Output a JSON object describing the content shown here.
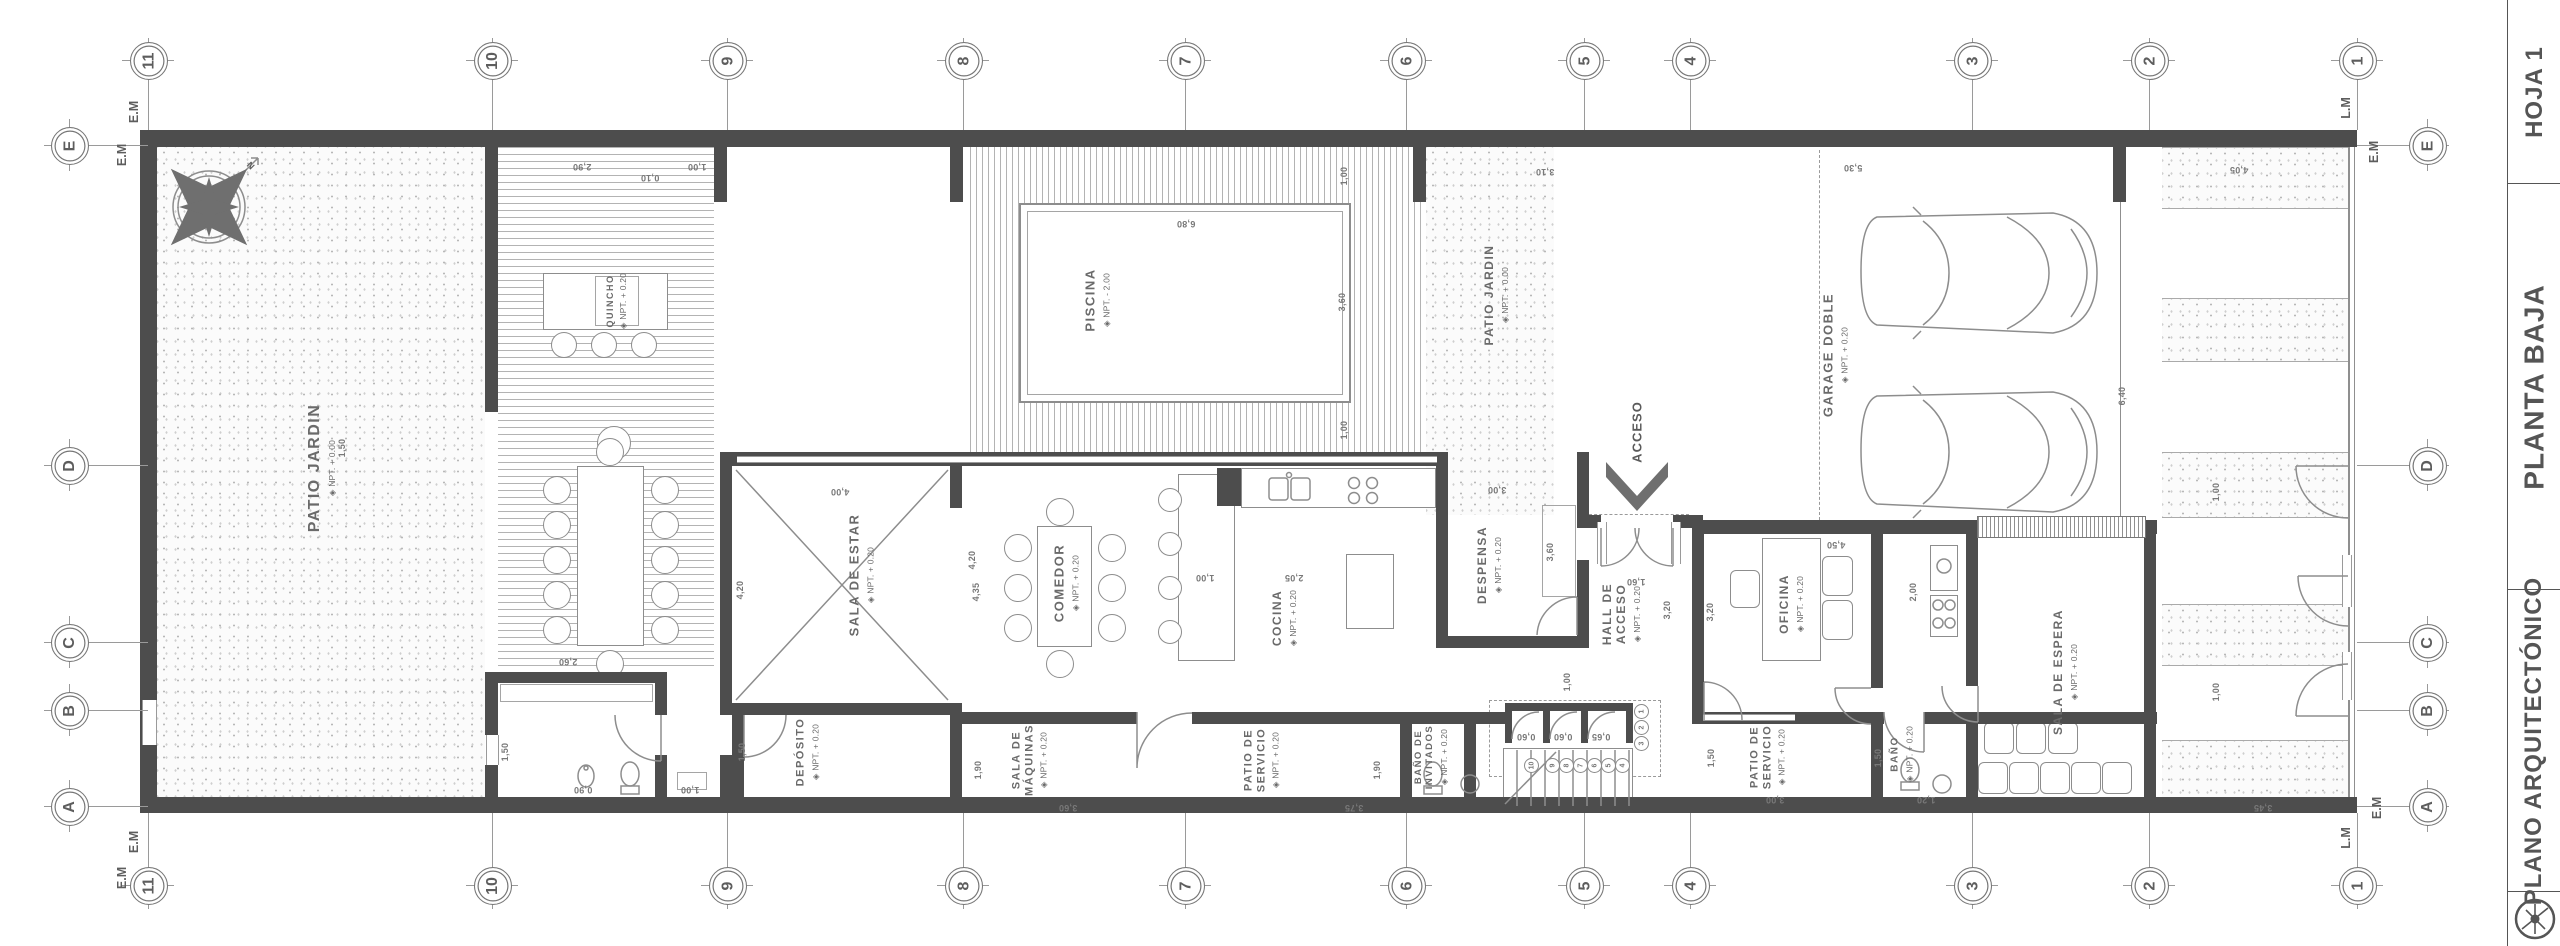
{
  "sheet_type": "architectural floor plan",
  "title_block": {
    "sections": [
      {
        "label": "HOJA 1"
      },
      {
        "label": "PLANTA BAJA"
      },
      {
        "label": "PLANO ARQUITECTÓNICO"
      }
    ]
  },
  "grid": {
    "columns": [
      {
        "label": "11",
        "x": 148
      },
      {
        "label": "10",
        "x": 492
      },
      {
        "label": "9",
        "x": 727
      },
      {
        "label": "8",
        "x": 963
      },
      {
        "label": "7",
        "x": 1185
      },
      {
        "label": "6",
        "x": 1406
      },
      {
        "label": "5",
        "x": 1584
      },
      {
        "label": "4",
        "x": 1690
      },
      {
        "label": "3",
        "x": 1972
      },
      {
        "label": "2",
        "x": 2149
      },
      {
        "label": "1",
        "x": 2357
      }
    ],
    "rows": [
      {
        "label": "E",
        "y": 145
      },
      {
        "label": "D",
        "y": 465
      },
      {
        "label": "C",
        "y": 642
      },
      {
        "label": "B",
        "y": 710
      },
      {
        "label": "A",
        "y": 806
      }
    ],
    "boundary_labels": [
      {
        "text": "E.M",
        "x": 134,
        "y": 112
      },
      {
        "text": "E.M",
        "x": 122,
        "y": 155
      },
      {
        "text": "L.M",
        "x": 2346,
        "y": 108
      },
      {
        "text": "E.M",
        "x": 2374,
        "y": 152
      },
      {
        "text": "E.M",
        "x": 134,
        "y": 842
      },
      {
        "text": "E.M",
        "x": 122,
        "y": 878
      },
      {
        "text": "E.M",
        "x": 2377,
        "y": 808
      },
      {
        "text": "L.M",
        "x": 2346,
        "y": 838
      }
    ]
  },
  "rooms": [
    {
      "name": "PATIO JARDIN",
      "elev": "NPT. + 0.00",
      "x": 322,
      "y": 468,
      "fs": 16
    },
    {
      "name": "QUINCHO",
      "elev": "NPT. + 0.20",
      "x": 617,
      "y": 301,
      "fs": 9
    },
    {
      "name": "PISCINA",
      "elev": "NPT. - 2.00",
      "x": 1098,
      "y": 300,
      "fs": 13
    },
    {
      "name": "PATIO JARDIN",
      "elev": "NPT. + 0.00",
      "x": 1497,
      "y": 295,
      "fs": 12
    },
    {
      "name": "GARAGE DOBLE",
      "elev": "NPT. + 0.20",
      "x": 1836,
      "y": 355,
      "fs": 13
    },
    {
      "name": "SALA DE ESTAR",
      "elev": "NPT. + 0.20",
      "x": 862,
      "y": 575,
      "fs": 13
    },
    {
      "name": "COMEDOR",
      "elev": "NPT. + 0.20",
      "x": 1067,
      "y": 583,
      "fs": 13
    },
    {
      "name": "COCINA",
      "elev": "NPT. + 0.20",
      "x": 1285,
      "y": 618,
      "fs": 12
    },
    {
      "name": "DESPENSA",
      "elev": "NPT. + 0.20",
      "x": 1490,
      "y": 565,
      "fs": 12
    },
    {
      "name": "HALL DE\nACCESO",
      "elev": "NPT. + 0.20",
      "x": 1622,
      "y": 614,
      "fs": 12
    },
    {
      "name": "OFICINA",
      "elev": "NPT. + 0.20",
      "x": 1792,
      "y": 604,
      "fs": 12
    },
    {
      "name": "SALA DE ESPERA",
      "elev": "NPT. + 0.20",
      "x": 2066,
      "y": 672,
      "fs": 12
    },
    {
      "name": "DEPÓSITO",
      "elev": "NPT. + 0.20",
      "x": 808,
      "y": 752,
      "fs": 11
    },
    {
      "name": "SALA DE\nMÁQUINAS",
      "elev": "NPT. + 0.20",
      "x": 1030,
      "y": 760,
      "fs": 11
    },
    {
      "name": "PATIO DE\nSERVICIO",
      "elev": "NPT. + 0.20",
      "x": 1262,
      "y": 760,
      "fs": 11
    },
    {
      "name": "BAÑO DE\nINVITADOS",
      "elev": "NPT. + 0.20",
      "x": 1432,
      "y": 757,
      "fs": 9.5
    },
    {
      "name": "PATIO DE\nSERVICIO",
      "elev": "NPT. + 0.20",
      "x": 1768,
      "y": 757,
      "fs": 11
    },
    {
      "name": "BAÑO",
      "elev": "NPT. + 0.20",
      "x": 1902,
      "y": 754,
      "fs": 10
    }
  ],
  "annotations": [
    {
      "text": "ACCESO",
      "x": 1637,
      "y": 432,
      "rot": -90,
      "fs": 13
    },
    {
      "text": "N",
      "x": 251,
      "y": 166,
      "rot": 45,
      "fs": 9
    }
  ],
  "dimensions": [
    {
      "t": "2,90",
      "x": 582,
      "y": 167,
      "r": 180
    },
    {
      "t": "0,10",
      "x": 650,
      "y": 178,
      "r": 180
    },
    {
      "t": "1,00",
      "x": 697,
      "y": 167,
      "r": 180
    },
    {
      "t": "3,10",
      "x": 1545,
      "y": 172,
      "r": 180
    },
    {
      "t": "6,80",
      "x": 1186,
      "y": 224,
      "r": 180
    },
    {
      "t": "1,00",
      "x": 1344,
      "y": 176,
      "r": -90
    },
    {
      "t": "3,60",
      "x": 1342,
      "y": 302,
      "r": -90
    },
    {
      "t": "1,00",
      "x": 1344,
      "y": 430,
      "r": -90
    },
    {
      "t": "5,30",
      "x": 1853,
      "y": 168,
      "r": 180
    },
    {
      "t": "4,05",
      "x": 2239,
      "y": 170,
      "r": 180
    },
    {
      "t": "6,40",
      "x": 2122,
      "y": 396,
      "r": -90
    },
    {
      "t": "4,00",
      "x": 840,
      "y": 492,
      "r": 180
    },
    {
      "t": "4,20",
      "x": 740,
      "y": 590,
      "r": -90
    },
    {
      "t": "4,20",
      "x": 972,
      "y": 560,
      "r": -90
    },
    {
      "t": "2,60",
      "x": 568,
      "y": 662,
      "r": 180
    },
    {
      "t": "1,50",
      "x": 505,
      "y": 752,
      "r": -90
    },
    {
      "t": "1,50",
      "x": 742,
      "y": 752,
      "r": -90
    },
    {
      "t": "0,90",
      "x": 583,
      "y": 790,
      "r": 180
    },
    {
      "t": "1,00",
      "x": 690,
      "y": 790,
      "r": 180
    },
    {
      "t": "1,50",
      "x": 342,
      "y": 448,
      "r": -90
    },
    {
      "t": "4,35",
      "x": 976,
      "y": 592,
      "r": -90
    },
    {
      "t": "1,00",
      "x": 1205,
      "y": 578,
      "r": 180
    },
    {
      "t": "2,05",
      "x": 1294,
      "y": 578,
      "r": 180
    },
    {
      "t": "3,00",
      "x": 1497,
      "y": 490,
      "r": 180
    },
    {
      "t": "3,60",
      "x": 1550,
      "y": 552,
      "r": -90
    },
    {
      "t": "1,60",
      "x": 1636,
      "y": 582,
      "r": 180
    },
    {
      "t": "3,20",
      "x": 1667,
      "y": 610,
      "r": -90
    },
    {
      "t": "3,20",
      "x": 1710,
      "y": 612,
      "r": -90
    },
    {
      "t": "1,00",
      "x": 1567,
      "y": 682,
      "r": -90
    },
    {
      "t": "4,50",
      "x": 1836,
      "y": 545,
      "r": 180
    },
    {
      "t": "2,00",
      "x": 1913,
      "y": 592,
      "r": -90
    },
    {
      "t": "3,60",
      "x": 1068,
      "y": 808,
      "r": 180
    },
    {
      "t": "3,75",
      "x": 1354,
      "y": 808,
      "r": 180
    },
    {
      "t": "1,90",
      "x": 978,
      "y": 770,
      "r": -90
    },
    {
      "t": "1,90",
      "x": 1377,
      "y": 770,
      "r": -90
    },
    {
      "t": "1,50",
      "x": 1711,
      "y": 758,
      "r": -90
    },
    {
      "t": "3,00",
      "x": 1775,
      "y": 800,
      "r": 180
    },
    {
      "t": "1,50",
      "x": 1878,
      "y": 758,
      "r": -90
    },
    {
      "t": "1,20",
      "x": 1926,
      "y": 800,
      "r": 180
    },
    {
      "t": "0,60",
      "x": 1526,
      "y": 737,
      "r": 180
    },
    {
      "t": "0,60",
      "x": 1563,
      "y": 737,
      "r": 180
    },
    {
      "t": "0,65",
      "x": 1601,
      "y": 737,
      "r": 180
    },
    {
      "t": "1,00",
      "x": 2216,
      "y": 492,
      "r": -90
    },
    {
      "t": "1,00",
      "x": 2216,
      "y": 692,
      "r": -90
    },
    {
      "t": "3,45",
      "x": 2263,
      "y": 808,
      "r": 180
    }
  ],
  "stairs": {
    "treads": [
      {
        "n": "1",
        "x": 1640,
        "y": 710
      },
      {
        "n": "2",
        "x": 1640,
        "y": 726
      },
      {
        "n": "3",
        "x": 1640,
        "y": 742
      },
      {
        "n": "4",
        "x": 1621,
        "y": 764
      },
      {
        "n": "5",
        "x": 1607,
        "y": 764
      },
      {
        "n": "6",
        "x": 1593,
        "y": 764
      },
      {
        "n": "7",
        "x": 1579,
        "y": 764
      },
      {
        "n": "8",
        "x": 1565,
        "y": 764
      },
      {
        "n": "9",
        "x": 1551,
        "y": 764
      },
      {
        "n": "10",
        "x": 1530,
        "y": 764
      }
    ]
  },
  "colors": {
    "wall": "#4d4d4d",
    "line": "#8d8d8d",
    "text": "#6a6a6a",
    "accent": "#555555"
  }
}
